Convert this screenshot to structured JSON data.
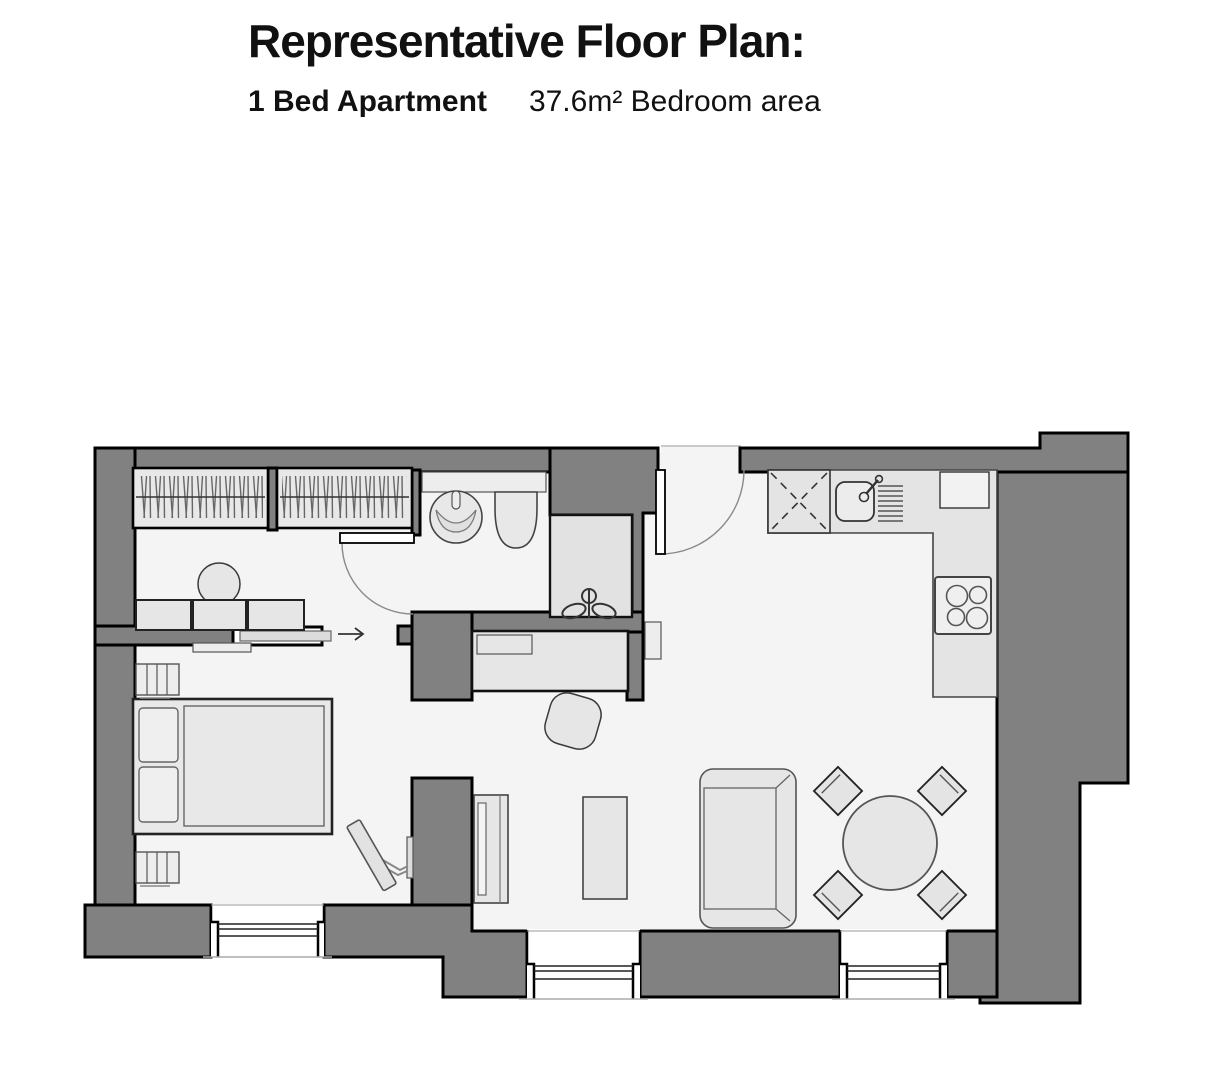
{
  "header": {
    "title": "Representative Floor Plan:",
    "unit_type": "1 Bed Apartment",
    "area_note": "37.6m² Bedroom area"
  },
  "colors": {
    "background": "#ffffff",
    "wall_fill": "#818181",
    "wall_outline": "#000000",
    "floor_fill": "#f4f4f4",
    "furniture_fill": "#e6e6e6",
    "furniture_outline": "#3a3a3a",
    "door_swing": "#8a8a8a"
  },
  "floor_plan": {
    "door_direction_arrow": "→",
    "items": [
      "wardrobe-left",
      "wardrobe-right",
      "dressing-table",
      "stool",
      "sliding-door",
      "entry-direction-arrow",
      "wash-basin",
      "toilet",
      "shower",
      "bathroom-door",
      "entrance-door",
      "desk",
      "desk-chair",
      "wall-panel",
      "double-bed",
      "pillows",
      "radiator-upper",
      "radiator-lower",
      "wall-shelf",
      "wall-mounted-tv",
      "kitchen-counter",
      "appliance-x-unit",
      "kitchen-sink",
      "drainer",
      "worktop-appliance",
      "hob",
      "tv-unit",
      "coffee-table",
      "sofa",
      "dining-table",
      "dining-chair-nw",
      "dining-chair-ne",
      "dining-chair-sw",
      "dining-chair-se",
      "window-bedroom",
      "window-living-left",
      "window-living-right"
    ]
  }
}
